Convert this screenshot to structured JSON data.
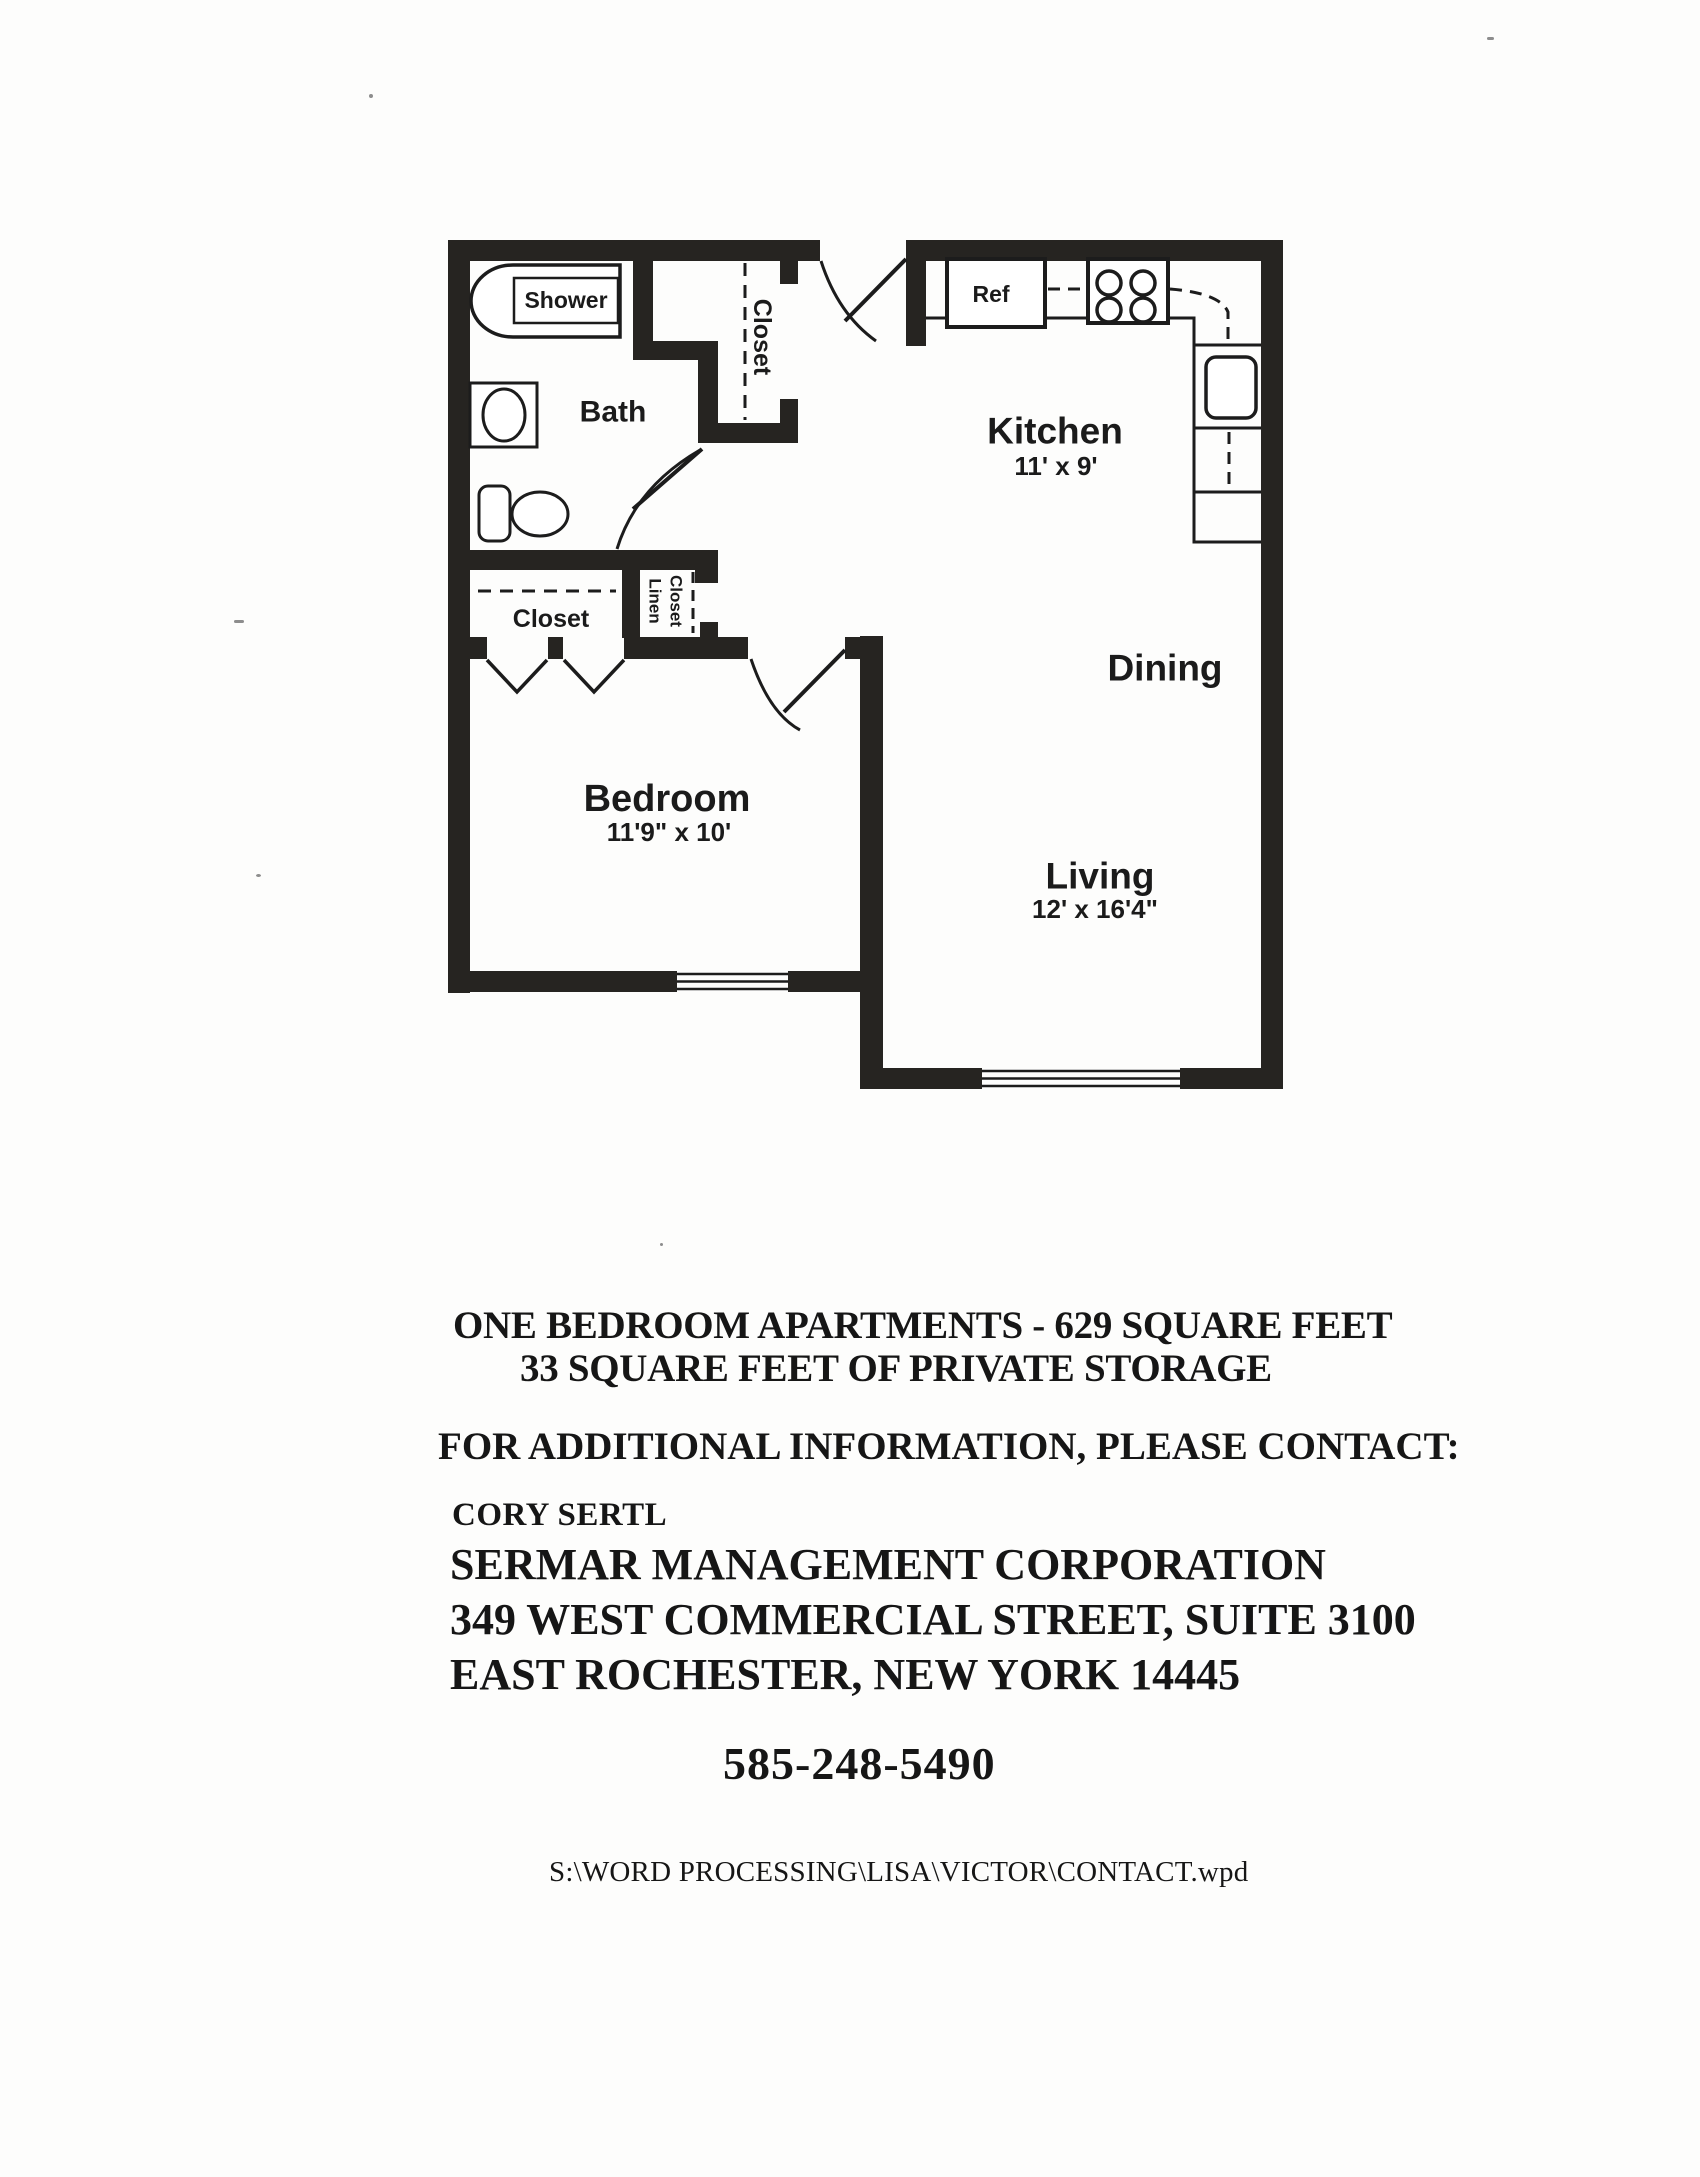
{
  "document": {
    "summary_line1": "ONE BEDROOM APARTMENTS - 629 SQUARE FEET",
    "summary_line2": "33 SQUARE FEET OF PRIVATE STORAGE",
    "contact_intro": "FOR ADDITIONAL INFORMATION, PLEASE CONTACT:",
    "contact_name": "CORY SERTL",
    "company": "SERMAR MANAGEMENT CORPORATION",
    "address_line1": "349 WEST COMMERCIAL STREET, SUITE 3100",
    "address_line2": "EAST ROCHESTER, NEW YORK 14445",
    "phone": "585-248-5490",
    "file_path": "S:\\WORD PROCESSING\\LISA\\VICTOR\\CONTACT.wpd"
  },
  "floor_plan": {
    "rooms": [
      {
        "name": "Kitchen",
        "dimensions": "11' x 9'"
      },
      {
        "name": "Dining",
        "dimensions": ""
      },
      {
        "name": "Living",
        "dimensions": "12' x 16'4\""
      },
      {
        "name": "Bedroom",
        "dimensions": "11'9\" x 10'"
      },
      {
        "name": "Bath",
        "dimensions": ""
      }
    ],
    "labels": {
      "shower": "Shower",
      "bath": "Bath",
      "ref": "Ref",
      "kitchen": "Kitchen",
      "kitchen_dims": "11' x 9'",
      "dining": "Dining",
      "living": "Living",
      "living_dims": "12' x 16'4\"",
      "bedroom": "Bedroom",
      "bedroom_dims": "11'9\" x 10'",
      "closet_entry": "Closet",
      "closet_bedroom": "Closet",
      "linen_line1": "Linen",
      "linen_line2": "Closet"
    }
  }
}
